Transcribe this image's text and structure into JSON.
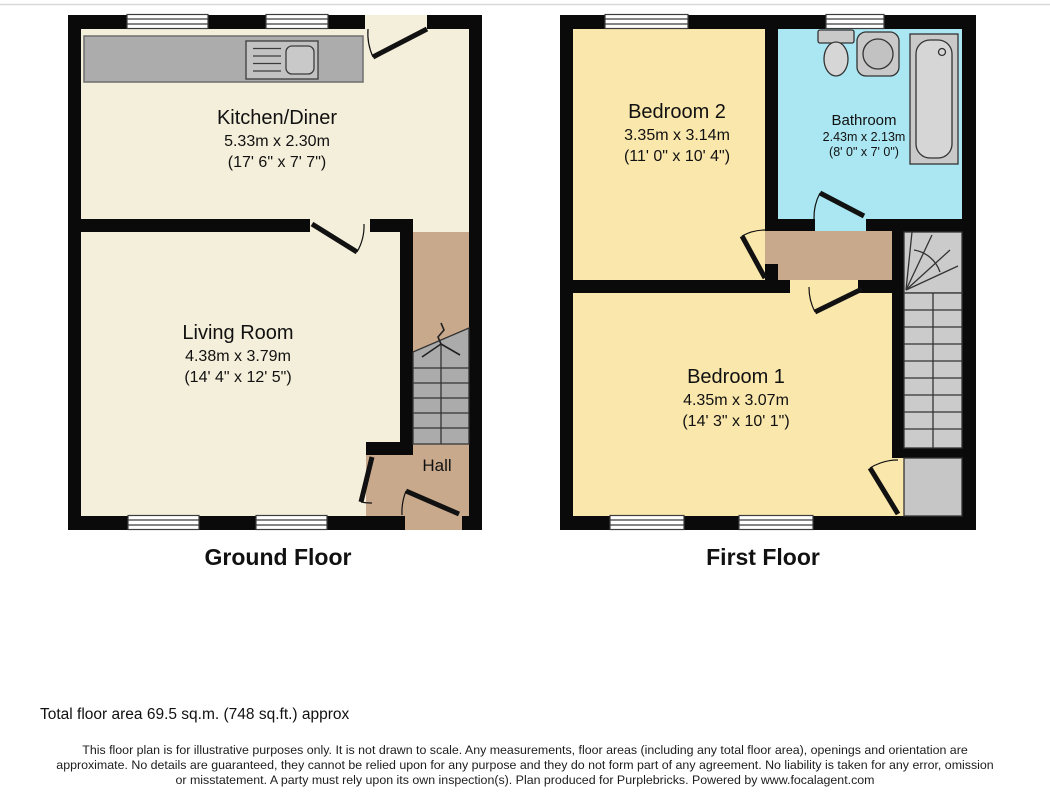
{
  "ground_floor": {
    "label": "Ground Floor",
    "rooms": {
      "kitchen_diner": {
        "name": "Kitchen/Diner",
        "metric": "5.33m x 2.30m",
        "imperial": "(17' 6\" x 7' 7\")"
      },
      "living_room": {
        "name": "Living Room",
        "metric": "4.38m x 3.79m",
        "imperial": "(14' 4\" x 12' 5\")"
      },
      "hall": {
        "name": "Hall"
      }
    }
  },
  "first_floor": {
    "label": "First Floor",
    "rooms": {
      "bedroom_2": {
        "name": "Bedroom 2",
        "metric": "3.35m x 3.14m",
        "imperial": "(11' 0\" x 10' 4\")"
      },
      "bathroom": {
        "name": "Bathroom",
        "metric": "2.43m x 2.13m",
        "imperial": "(8' 0\" x 7' 0\")"
      },
      "bedroom_1": {
        "name": "Bedroom 1",
        "metric": "4.35m x 3.07m",
        "imperial": "(14' 3\" x 10' 1\")"
      }
    }
  },
  "footer": {
    "total_area": "Total floor area 69.5 sq.m. (748 sq.ft.) approx",
    "disclaimer_lines": [
      "This floor plan is for illustrative purposes only. It is not drawn to scale. Any measurements, floor areas (including any total floor area), openings and orientation are",
      "approximate. No details are guaranteed, they cannot be relied upon for any purpose and they do not form part of any agreement. No liability is taken for any error, omission",
      "or misstatement. A party must rely upon its own inspection(s). Plan produced for Purplebricks. Powered by www.focalagent.com"
    ]
  },
  "colors": {
    "wall": "#0a0a0a",
    "ground_room_fill": "#f4efda",
    "bedroom_fill": "#fae7ac",
    "bathroom_fill": "#abe7f2",
    "hall_landing_fill": "#c9a98c",
    "stairs_fill": "#ababab",
    "counter_fill": "#acacac"
  }
}
